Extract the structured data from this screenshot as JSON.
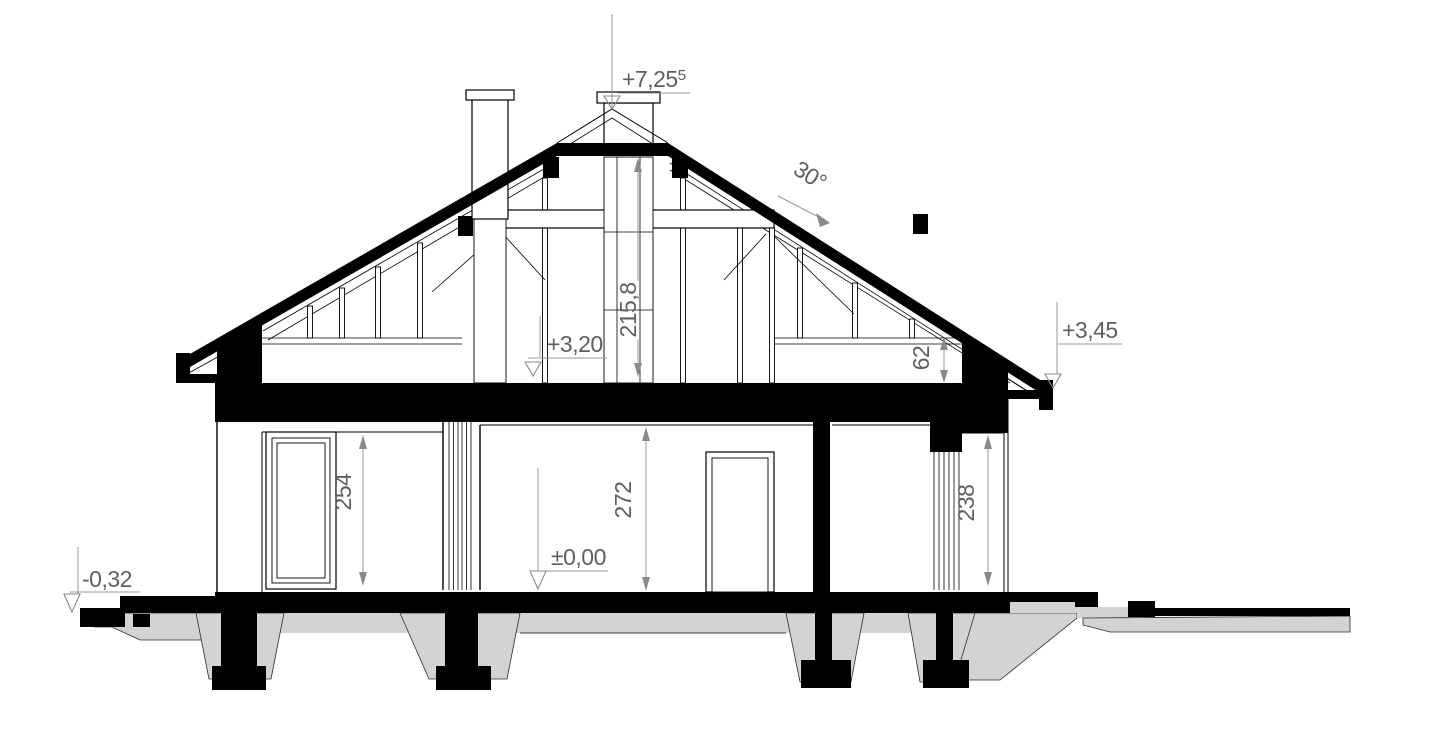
{
  "levels": {
    "ridge": {
      "value": "+7,25",
      "sup": "5"
    },
    "eaves_right": "+3,45",
    "attic_floor": "+3,20",
    "ground_floor": "±0,00",
    "terrain_left": "-0,32"
  },
  "roof": {
    "pitch": "30°"
  },
  "dimensions": {
    "attic_height": "215,8",
    "knee_wall_height": "62",
    "room_left_height": "254",
    "room_center_height": "272",
    "porch_right_height": "238"
  },
  "colors": {
    "ink": "#000000",
    "concrete": "#d3d3d5",
    "dim_text": "#5f5f5f",
    "dim_line": "#9a9a9a",
    "background": "#ffffff"
  }
}
